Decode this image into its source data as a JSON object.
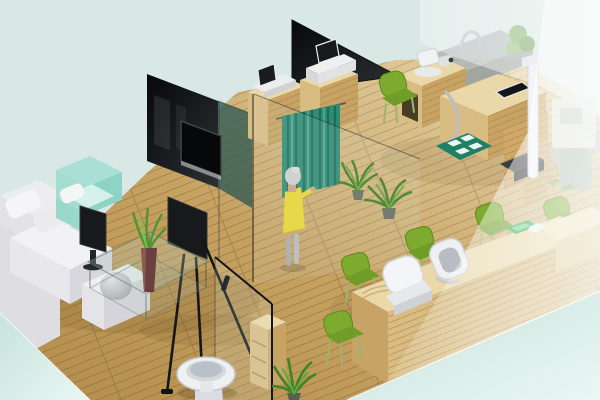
{
  "scene": {
    "description": "3D isometric rendering of a clinic / office interior: waiting lounge with white sectional sofa and mint armchair, display easel, glass coffee table with aloe vase, dark glass partition walls with wall TV, two wooden device cabinets, teal privacy curtain with standing woman in a yellow dress, potted floor plants, restroom with glass door and toilet, optometry exam desk with instruments and height scale, long wooden reception counter with white task chairs and green visitor chairs, frosted glass partitions on the right",
    "canvas": {
      "width": 600,
      "height": 400
    },
    "objects": [
      "background",
      "wood-floor",
      "waiting-sofa",
      "sofa-ball-cushion",
      "accent-armchair",
      "floor-monitor",
      "display-easel",
      "coffee-table",
      "plant-vase",
      "dark-wall-panel-left",
      "wall-tv",
      "tinted-glass-panel",
      "dark-wall-panel-center",
      "device-cabinet-1",
      "device-1",
      "device-cabinet-2",
      "device-2",
      "privacy-curtain",
      "standing-person",
      "floor-plant-1",
      "floor-plant-2",
      "glass-partition-center",
      "restroom-shelf",
      "restroom-glass-door",
      "door-handle",
      "toilet",
      "floor-plant-3",
      "exam-desk",
      "exam-device-camera",
      "exam-screen",
      "exam-step-mat",
      "exam-chair",
      "height-scale",
      "back-room-sink",
      "back-room-plant",
      "reception-counter",
      "counter-tray",
      "reception-chair-1",
      "reception-chair-2",
      "visitor-chair-1",
      "visitor-chair-2",
      "visitor-chair-3",
      "visitor-chair-4",
      "visitor-chair-5",
      "frosted-partition-top",
      "frosted-partition-right",
      "foreground-glass-slab",
      "floor-slab-corner"
    ]
  },
  "colors": {
    "background": "#d9e8e4",
    "floor_wood": "#c6a160",
    "wood_top": "#ead8a8",
    "wood_front": "#d9bc82",
    "wood_side": "#c7a465",
    "dark_panel": "#0d0f11",
    "glass_tint": "#2e5a52",
    "curtain_teal": "#2f8c75",
    "accent_mint": "#aadfd6",
    "chair_green": "#76a42c",
    "plant_green": "#4f9630",
    "person_dress": "#e8d52f",
    "sofa_white": "#ededf0",
    "porcelain": "#eef0f2",
    "chrome": "#b9bec2",
    "frost_white": "#ffffff",
    "slab_teal": "#d3e9e4",
    "tray_green": "#2fae4e",
    "base_dark": "#3b3e43"
  }
}
